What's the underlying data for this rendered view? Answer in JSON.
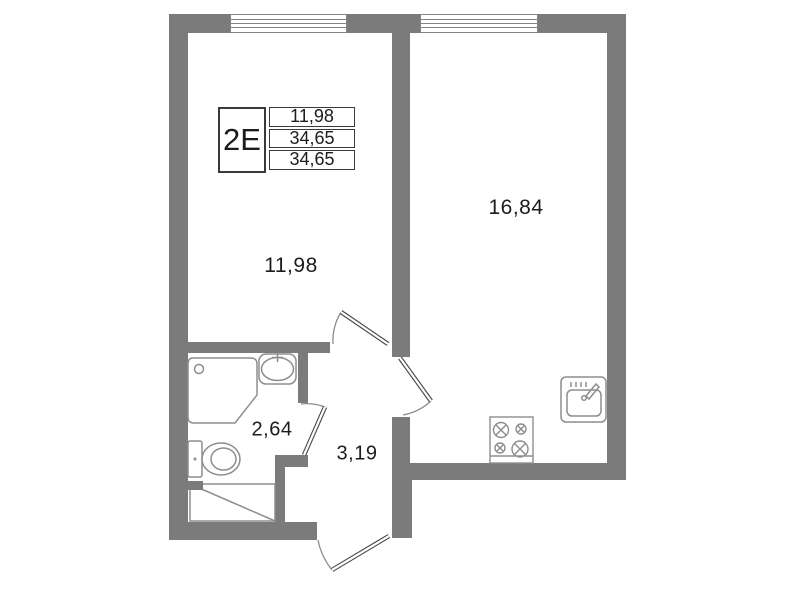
{
  "unit": {
    "type_label": "2Е",
    "stats": [
      "11,98",
      "34,65",
      "34,65"
    ]
  },
  "rooms": {
    "living": {
      "area": "11,98"
    },
    "kitchen": {
      "area": "16,84"
    },
    "bathroom": {
      "area": "2,64"
    },
    "hallway": {
      "area": "3,19"
    }
  },
  "fixtures": [
    "shower-cabin-icon",
    "washbasin-icon",
    "toilet-icon",
    "washing-machine-area-icon",
    "stove-icon",
    "kitchen-sink-icon",
    "door-swing-icon",
    "window-icon"
  ],
  "colors": {
    "wall": "#7b7b7b",
    "fixture_line": "#8d8d8d",
    "door_line": "#4a4a4a",
    "text": "#1c1c1c"
  }
}
